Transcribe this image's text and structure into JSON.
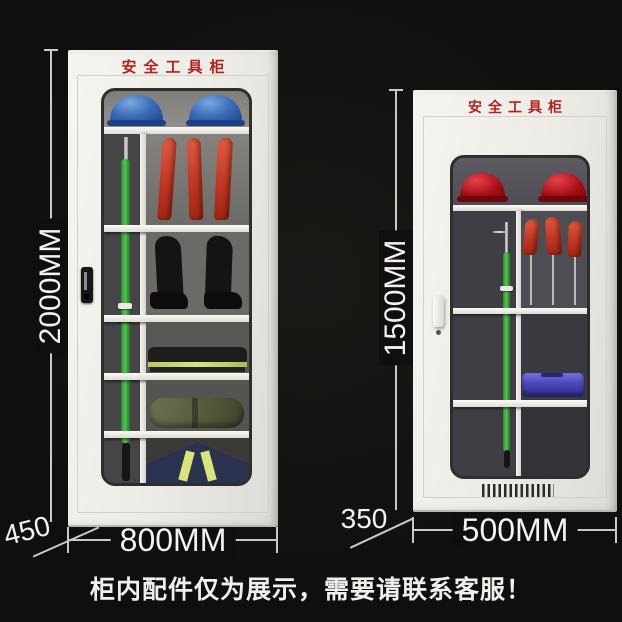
{
  "page": {
    "caption": "柜内配件仅为展示，需要请联系客服！"
  },
  "colors": {
    "page_bg": "#100f0e",
    "cabinet_body": "#eeede8",
    "title_red": "#b0231e",
    "dim_line": "#c9c9c6",
    "dim_text": "#f2f2f0",
    "helmet_blue": "#3566b4",
    "helmet_red": "#a80f16",
    "glove_red": "#d2442c",
    "rod_green": "#3da83a",
    "case_blue": "#4a47b4",
    "reflective_yellow": "#d8e57c"
  },
  "large_cabinet": {
    "title": "安全工具柜",
    "height_label": "2000MM",
    "width_label": "800MM",
    "depth_label": "450"
  },
  "small_cabinet": {
    "title": "安全工具柜",
    "height_label": "1500MM",
    "width_label": "500MM",
    "depth_label": "350"
  }
}
